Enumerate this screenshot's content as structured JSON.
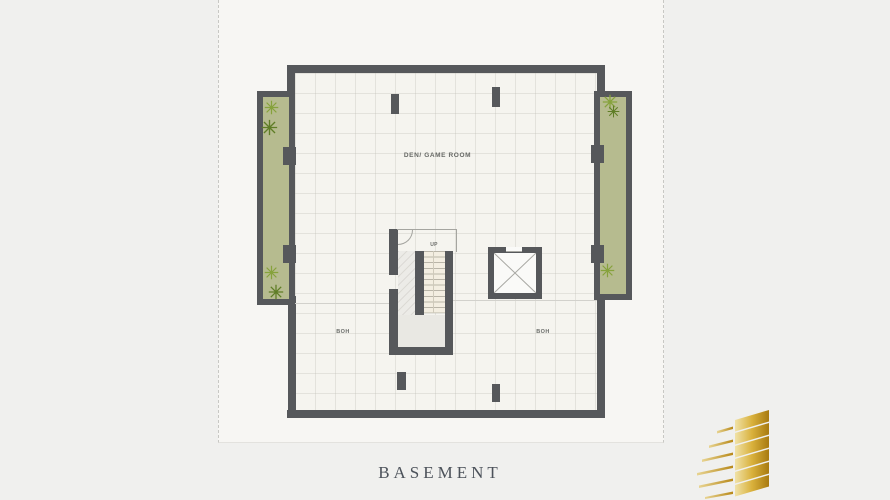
{
  "page": {
    "background_color": "#f0f0ee",
    "sheet_color": "#f7f6f3",
    "title": "BASEMENT"
  },
  "plan": {
    "room_label": "DEN/ GAME ROOM",
    "boh_left_label": "BOH",
    "boh_right_label": "BOH",
    "up_label": "UP",
    "colors": {
      "wall": "#56585b",
      "planter_green": "#b6bb8f",
      "plant_green": "#7f9a35",
      "floor": "#f5f4ef",
      "stair_tread": "#f3eee1",
      "stair_landing": "#e9e8e3"
    },
    "icons": {
      "plant": "asterisk-foliage-symbol",
      "elevator": "x-cross-shaft-symbol",
      "door": "quarter-arc-swing"
    }
  },
  "logo": {
    "name": "gold-layered-building-mark",
    "gold_dark": "#a87a10",
    "gold_light": "#f0e2a8"
  }
}
